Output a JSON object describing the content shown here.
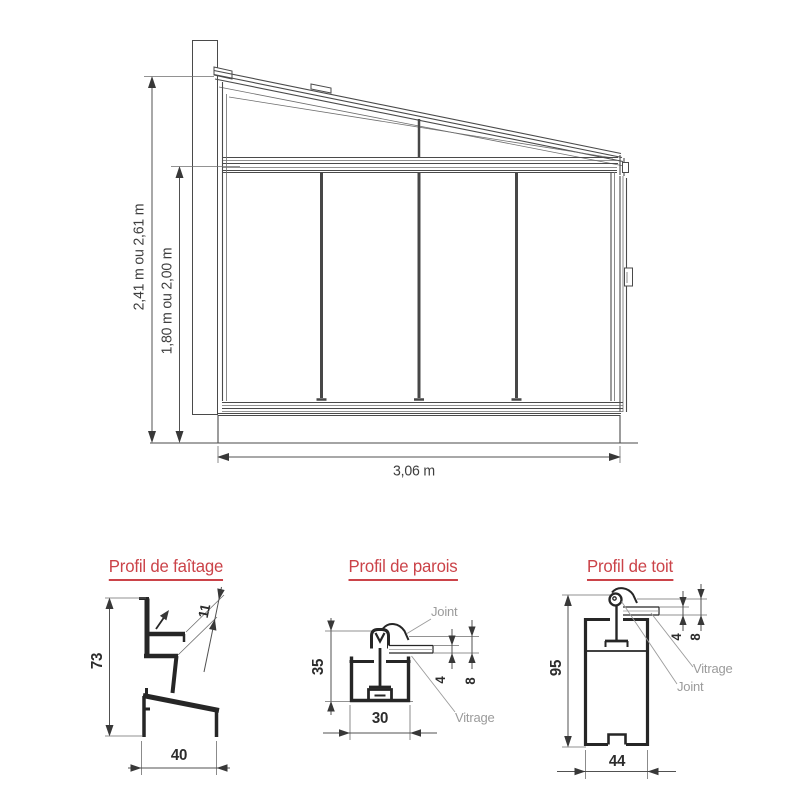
{
  "elevation": {
    "dim_total_height": "2,41 m ou 2,61 m",
    "dim_front_height": "1,80 m ou 2,00 m",
    "dim_width": "3,06 m"
  },
  "sections": [
    {
      "title": "Profil de faîtage",
      "dims": {
        "height": "73",
        "rebate": "11",
        "width": "40"
      }
    },
    {
      "title": "Profil de parois",
      "dims": {
        "height": "35",
        "width": "30",
        "glass": "4",
        "glass_joint": "8"
      },
      "labels": {
        "joint": "Joint",
        "glazing": "Vitrage"
      }
    },
    {
      "title": "Profil de toit",
      "dims": {
        "height": "95",
        "width": "44",
        "glass": "4",
        "glass_joint": "8"
      },
      "labels": {
        "joint": "Joint",
        "glazing": "Vitrage"
      }
    }
  ],
  "colors": {
    "accent": "#cb4349",
    "ink": "#262626",
    "line": "#4a4a4a",
    "muted": "#9b9b9b"
  }
}
